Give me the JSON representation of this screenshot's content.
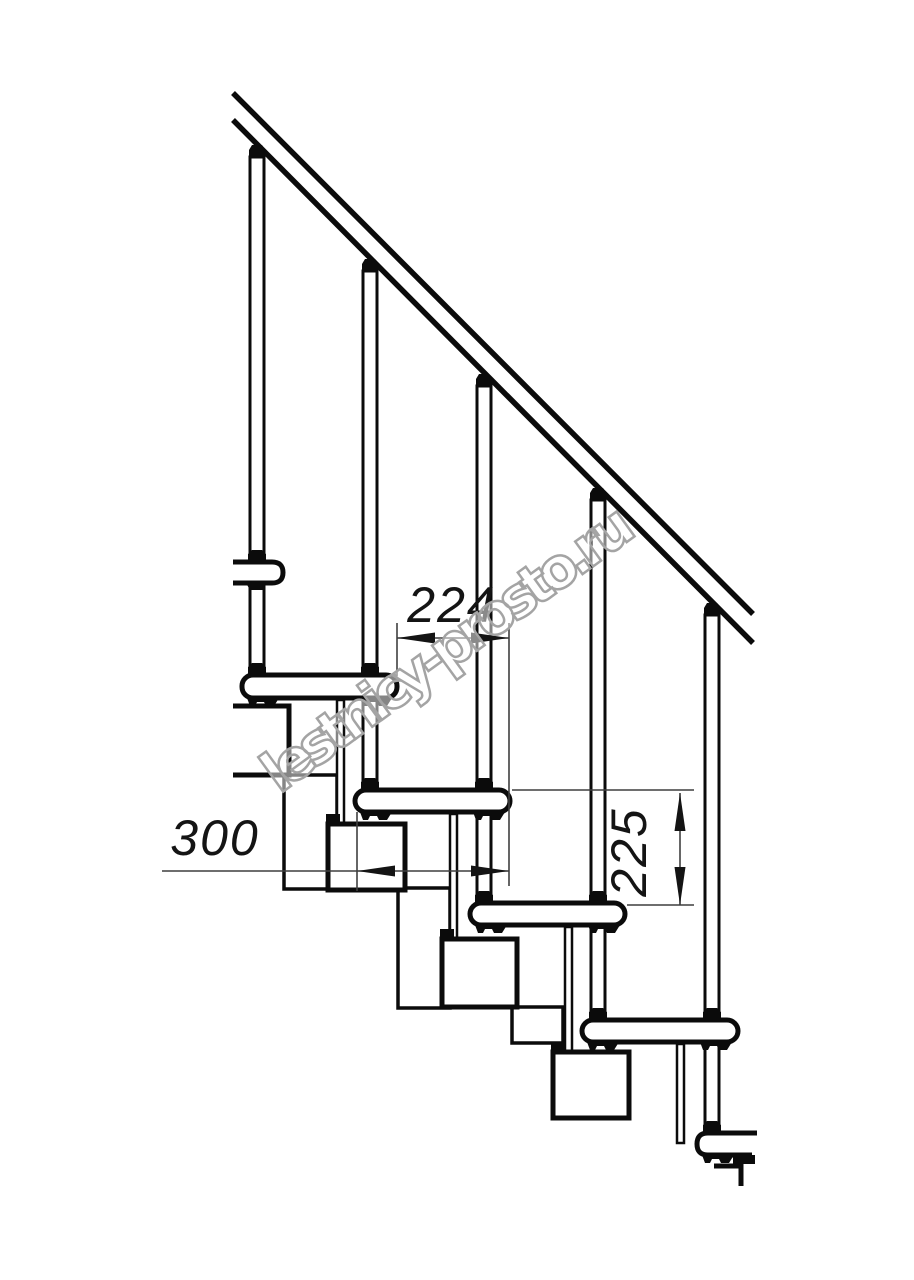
{
  "watermark": {
    "text": "lestnicy-prosto.ru",
    "color": "#a4a4a4"
  },
  "drawing": {
    "type": "technical-drawing",
    "subject": "modular staircase side elevation",
    "colors": {
      "line": "#0b0b0b",
      "dimension_line": "#3f3f3f",
      "background": "#ffffff"
    },
    "dimensions": [
      {
        "id": "step-run",
        "value": "224",
        "orientation": "horizontal"
      },
      {
        "id": "tread-length",
        "value": "300",
        "orientation": "horizontal"
      },
      {
        "id": "riser-height",
        "value": "225",
        "orientation": "vertical"
      }
    ],
    "counts": {
      "treads_visible": 6,
      "balusters_visible": 5,
      "stringer_modules_visible": 4
    }
  }
}
